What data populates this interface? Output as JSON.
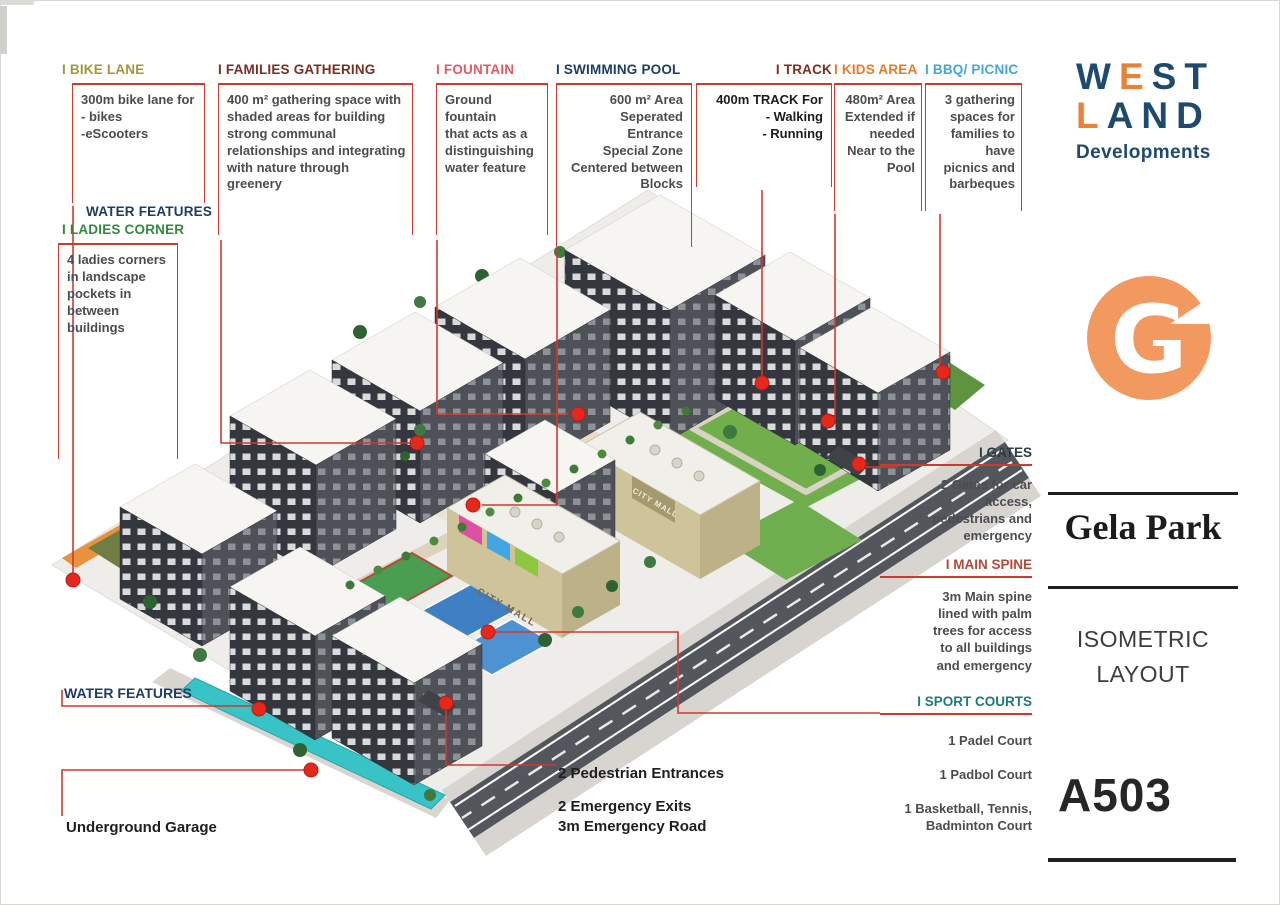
{
  "brand": {
    "west_w": "W",
    "west_e": "E",
    "west_s": "S",
    "west_t": "T",
    "land_l": "L",
    "land_a": "A",
    "land_n": "N",
    "land_d": "D",
    "developments": "Developments",
    "logo_letter": "G",
    "navy": "#1d4a6e",
    "orange": "#e98137",
    "logo_orange": "#f2995f"
  },
  "project": {
    "name": "Gela Park",
    "layout_type": "ISOMETRIC\nLAYOUT",
    "unit_code": "A503"
  },
  "annotations": {
    "bike_lane": {
      "title": "I BIKE LANE",
      "body": "300m bike lane for\n- bikes\n-eScooters"
    },
    "families_gathering": {
      "title": "I FAMILIES GATHERING",
      "body": "400 m² gathering space with\nshaded areas for building\nstrong communal\nrelationships and integrating\nwith nature through greenery"
    },
    "fountain": {
      "title": "I FOUNTAIN",
      "body": "Ground fountain\nthat acts as a\ndistinguishing\nwater feature"
    },
    "swimming_pool": {
      "title": "I SWIMMING POOL",
      "body": "600 m² Area\nSeperated Entrance\nSpecial Zone\nCentered between\nBlocks"
    },
    "track": {
      "title": "I TRACK",
      "body": "400m TRACK For\n- Walking\n- Running"
    },
    "kids_area": {
      "title": "I KIDS AREA",
      "body": "480m² Area\nExtended if\nneeded\nNear to the\nPool"
    },
    "bbq_picnic": {
      "title": "I BBQ/ PICNIC",
      "body": "3 gathering\nspaces for\nfamilies to have\npicnics and\nbarbeques"
    },
    "water_features_top": {
      "title": "WATER FEATURES"
    },
    "ladies_corner": {
      "title": "I LADIES CORNER",
      "body": "4 ladies corners\nin landscape\npockets in\nbetween\nbuildings"
    },
    "gates": {
      "title": "I GATES",
      "body": "2 Gates for car\naccess,\npedestrians and\nemergency"
    },
    "main_spine": {
      "title": "I MAIN SPINE",
      "body": "3m Main spine\nlined with palm\ntrees for access\nto all buildings\nand emergency"
    },
    "sport_courts": {
      "title": "I SPORT COURTS",
      "items": [
        "1 Padel Court",
        "1 Padbol Court",
        "1 Basketball, Tennis,\nBadminton Court"
      ]
    },
    "water_features_bottom": {
      "title": "WATER FEATURES"
    },
    "underground_garage": {
      "label": "Underground Garage"
    },
    "pedestrian_entrances": {
      "label": "2 Pedestrian Entrances"
    },
    "emergency": {
      "label": "2 Emergency Exits\n3m Emergency Road"
    }
  },
  "scene": {
    "mall_sign": "CITY MALL",
    "leader_color": "#d03a2c",
    "dot_color": "#e6281c"
  }
}
